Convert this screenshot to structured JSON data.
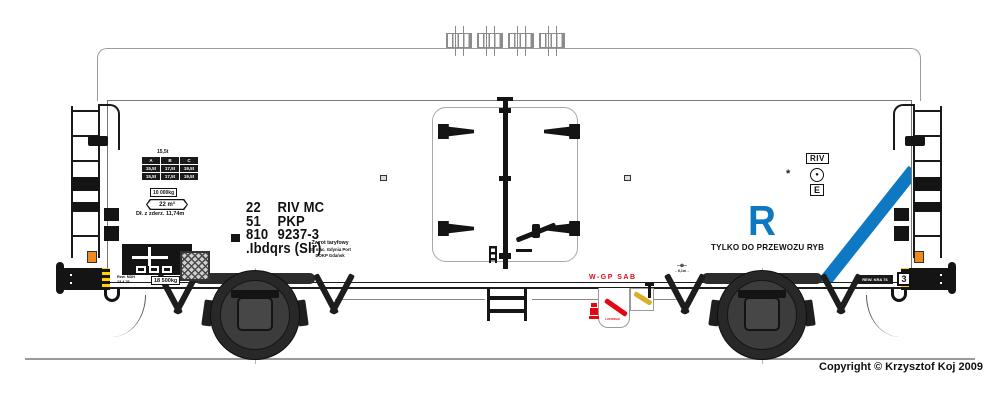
{
  "colors": {
    "blue": "#0e79c2",
    "red": "#e30613",
    "lever_yellow": "#d9b127",
    "buffer_yellow": "#ffd400",
    "orange": "#ee8a1e"
  },
  "wagon": {
    "number_rows": [
      {
        "c1": "22",
        "c2": "RIV MC"
      },
      {
        "c1": "51",
        "c2": "PKP"
      },
      {
        "c1": "810",
        "c2": "9237-3"
      }
    ],
    "class_line": ".Ibdqrs (Slr)",
    "station": {
      "line1": "Zwrot taryfowy",
      "line2": "St. mac. Gdynia Port",
      "line3": "DOKP Gdańsk"
    }
  },
  "plates": {
    "top_weight": "15,5t",
    "load_table": {
      "rows": [
        [
          "A",
          "B",
          "C"
        ],
        [
          "15,5t",
          "17,5t",
          "19,5t"
        ],
        [
          "15,5t",
          "17,5t",
          "19,5t"
        ]
      ]
    },
    "weight_box": "10 000kg",
    "volume": "22 m³",
    "length": "Dł. z zderz. 11,74m",
    "tare_box": "18 500kg",
    "rev_small": {
      "line1": "Rew. NDH",
      "line2": "23.4.76"
    }
  },
  "fish": {
    "letter": "R",
    "slogan": "TYLKO DO PRZEWOZU RYB"
  },
  "right_marks": {
    "riv": "RIV",
    "ferry_dot": "●",
    "e": "E",
    "symbol": "*",
    "grid_number": "3",
    "rev_plate": "REW. KRA 76"
  },
  "brake_label": "W-GP SAB",
  "brake_small": "LUZOWAĆ",
  "axle_mark": {
    "top": "–⊕–",
    "bottom": "←6,1m→"
  },
  "copyright": "Copyright © Krzysztof Koj 2009"
}
